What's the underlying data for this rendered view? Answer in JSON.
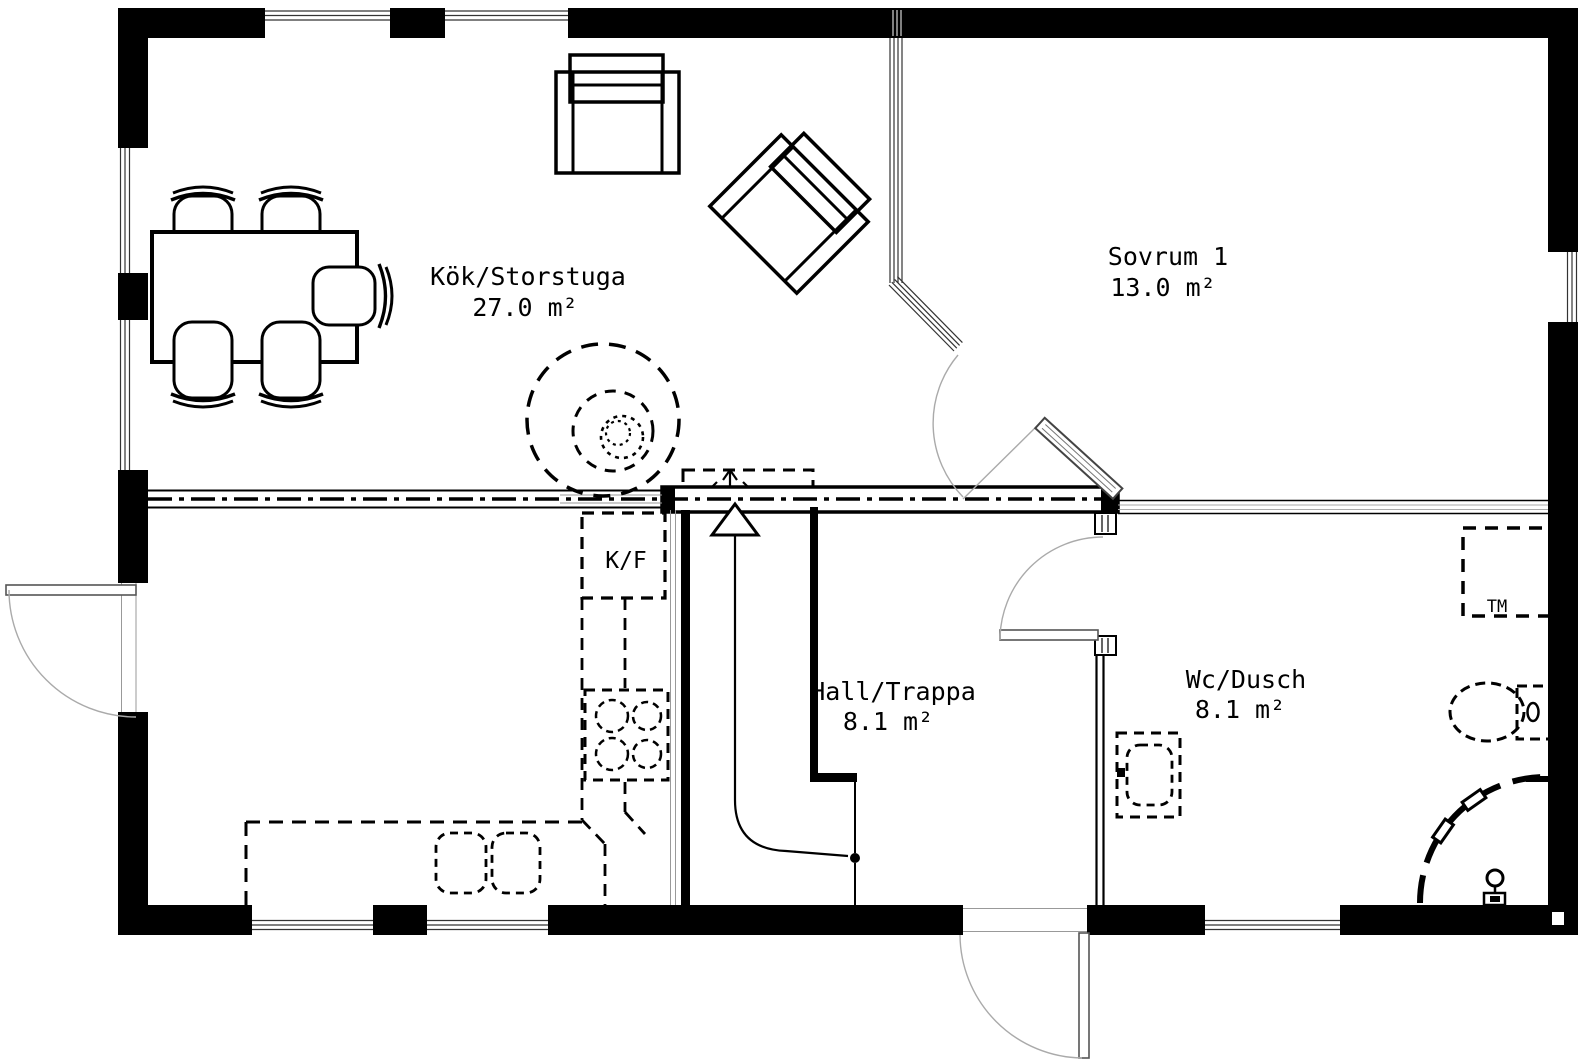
{
  "plan": {
    "rooms": [
      {
        "name": "Kök/Storstuga",
        "area": "27.0 m²"
      },
      {
        "name": "Sovrum 1",
        "area": "13.0 m²"
      },
      {
        "name": "Hall/Trappa",
        "area": "8.1 m²"
      },
      {
        "name": "Wc/Dusch",
        "area": "8.1 m²"
      }
    ],
    "labels": {
      "fridge_freezer": "K/F",
      "washing_machine": "TM"
    },
    "colors": {
      "walls": "#000000",
      "background": "#ffffff",
      "swing_lines": "#999999"
    }
  }
}
